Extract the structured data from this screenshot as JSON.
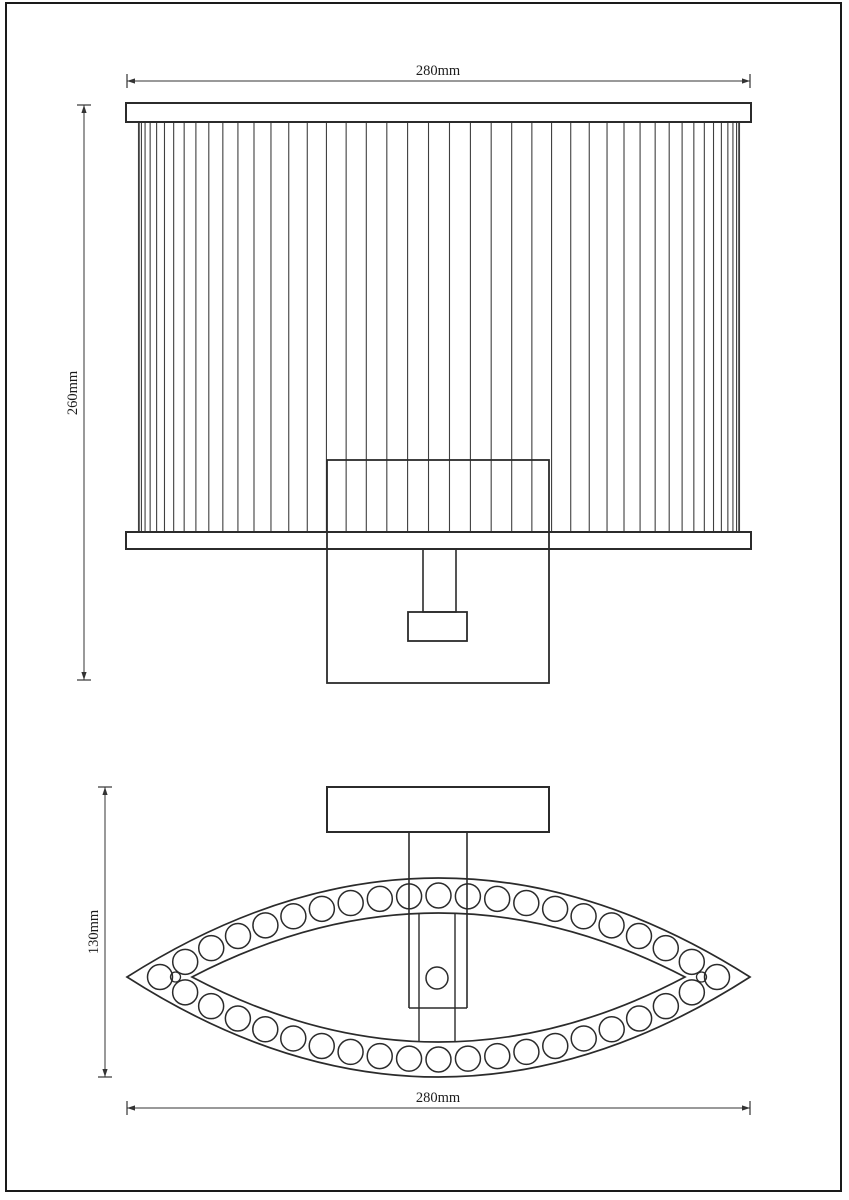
{
  "sheet": {
    "width": 849,
    "height": 1200,
    "background": "#ffffff",
    "border_color": "#1a1a1a",
    "main_line_color": "#2b2b2b",
    "thin_line_color": "#3f3f3f",
    "border": {
      "x1": 6,
      "y1": 3,
      "x2": 841,
      "y2": 1191
    }
  },
  "views": {
    "front": {
      "name": "front-elevation-of-wall-lamp",
      "canopy_bar": {
        "x1": 126,
        "x2": 751,
        "y1": 103,
        "y2": 122
      },
      "bottom_rim": {
        "x1": 126,
        "x2": 751,
        "y1": 532,
        "y2": 549
      },
      "shade": {
        "cx": 439,
        "radius": 300.5,
        "top": 122,
        "bottom": 532,
        "pleats": 45
      },
      "wall_plate": {
        "x1": 327,
        "x2": 549,
        "y1": 460,
        "y2": 683
      },
      "stem": {
        "x1": 423,
        "x2": 456,
        "y1": 549,
        "y2": 612
      },
      "socket": {
        "x1": 408,
        "x2": 467,
        "y1": 612,
        "y2": 641
      }
    },
    "top": {
      "name": "top-view-of-wall-lamp",
      "wall_plate": {
        "x1": 327,
        "x2": 549,
        "y1": 787,
        "y2": 832
      },
      "arm_outer": {
        "x1": 409,
        "x2": 467,
        "y1": 832,
        "y2": 1008
      },
      "arm_inner": {
        "x1": 419,
        "x2": 455,
        "y1": 913,
        "y2": 1042
      },
      "pivot_circle": {
        "cx": 437,
        "cy": 978,
        "r": 11
      },
      "lens_outer": {
        "x1": 127,
        "x2": 750,
        "cy": 977,
        "top": 878,
        "bottom": 1077
      },
      "lens_inner": {
        "x1": 192,
        "x2": 685,
        "cy": 977,
        "top": 913,
        "bottom": 1042
      },
      "beads": {
        "radius": 12.5,
        "top_arc": {
          "x1": 160,
          "x2": 717,
          "y": 977,
          "apex_y": 895.5,
          "count": 21,
          "skip_ends": false
        },
        "bottom_arc": {
          "x1": 160,
          "x2": 717,
          "y": 977,
          "apex_y": 1059.5,
          "count": 21,
          "skip_ends": true
        },
        "tip_small": [
          {
            "cx": 175.5,
            "cy": 977,
            "r": 5
          },
          {
            "cx": 701.5,
            "cy": 977,
            "r": 5
          }
        ]
      }
    }
  },
  "dimensions": [
    {
      "id": "front-width",
      "label": "280mm",
      "orient": "h",
      "x1": 127,
      "x2": 750,
      "y": 81,
      "label_x": 438,
      "label_y": 75
    },
    {
      "id": "front-height",
      "label": "260mm",
      "orient": "v",
      "x": 84,
      "y1": 105,
      "y2": 680,
      "label_x": 77,
      "label_y": 393
    },
    {
      "id": "top-depth",
      "label": "130mm",
      "orient": "v",
      "x": 105,
      "y1": 787,
      "y2": 1077,
      "label_x": 98,
      "label_y": 932
    },
    {
      "id": "top-width",
      "label": "280mm",
      "orient": "h",
      "x1": 127,
      "x2": 750,
      "y": 1108,
      "label_x": 438,
      "label_y": 1102
    }
  ]
}
